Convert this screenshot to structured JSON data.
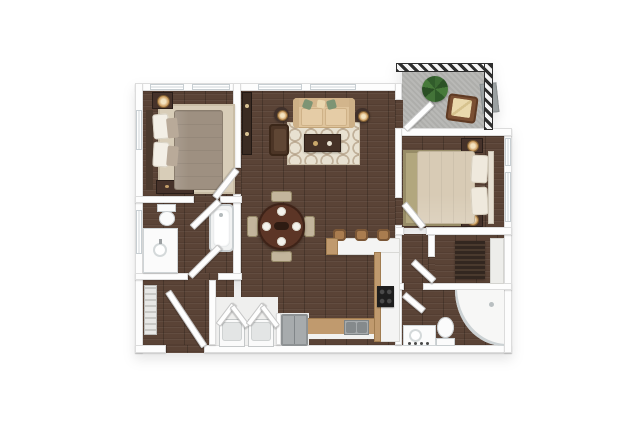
{
  "meta": {
    "image_type": "3d-floor-plan-rendering",
    "view": "top-down",
    "unit_type": "apartment",
    "bedroom_count": 2,
    "bathroom_count": 2,
    "visible_text": ""
  },
  "colors": {
    "bg": "#ffffff",
    "wood": "#5a4336",
    "wall": "#fdfdfd",
    "wall_edge": "#dcdcdc",
    "concrete": "#b5b5b2",
    "rug_beige": "#d8cdb8",
    "rug_cream": "#e8e1d1",
    "rug_olive": "#b2a77e",
    "sofa": "#dfc49c",
    "pillow_green": "#7d9474",
    "dark_wood": "#46322a",
    "bed1": "#9e9081",
    "bed2": "#d8cbb5",
    "lamp": "#c9995c",
    "lamp_glow": "#f3e3c0",
    "fixture": "#fbfbfb",
    "fixture_edge": "#c9ced0",
    "counter": "#f4f4f3",
    "counter_wood": "#c09a6e",
    "steel": "#a7abad",
    "steel_dark": "#8e9294",
    "cooktop": "#1e1e1e",
    "table_wood": "#5c3526",
    "chair": "#c3b59c",
    "stool": "#a97c4f",
    "clothes": "#332720",
    "plant": "#3c6b33",
    "pot": "#8f8f8d",
    "screen_gray": "#9aa0a1",
    "railing": "#2e2e2e"
  },
  "rooms": [
    {
      "id": "bedroom-1",
      "furniture": [
        "bed",
        "nightstand-with-lamp",
        "dresser",
        "area-rug"
      ]
    },
    {
      "id": "living-room",
      "furniture": [
        "sofa",
        "green-accent-pillows",
        "end-table-lamp-left",
        "end-table-lamp-right",
        "armchair",
        "coffee-table",
        "patterned-area-rug",
        "media-console"
      ]
    },
    {
      "id": "dining-area",
      "furniture": [
        "round-dining-table",
        "four-place-settings",
        "four-dining-chairs"
      ]
    },
    {
      "id": "kitchen",
      "furniture": [
        "breakfast-bar",
        "three-bar-stools",
        "cooktop",
        "double-basin-sink",
        "base-cabinets",
        "refrigerator"
      ]
    },
    {
      "id": "bathroom-1",
      "furniture": [
        "toilet",
        "vanity-with-sink",
        "bathtub"
      ]
    },
    {
      "id": "entry-hall",
      "furniture": [
        "entry-door",
        "linen-shelves"
      ]
    },
    {
      "id": "laundry-closet",
      "furniture": [
        "washer",
        "dryer",
        "bifold-doors"
      ]
    },
    {
      "id": "bedroom-2",
      "furniture": [
        "bed",
        "nightstand-with-lamp-upper",
        "nightstand-with-lamp-lower",
        "area-rug"
      ]
    },
    {
      "id": "walk-in-closet",
      "furniture": [
        "hanging-clothes",
        "shelf"
      ]
    },
    {
      "id": "bathroom-2",
      "furniture": [
        "vanity-with-sink",
        "toilet",
        "curved-shower"
      ]
    },
    {
      "id": "balcony",
      "furniture": [
        "potted-plant",
        "patio-chair",
        "privacy-screen",
        "railing"
      ]
    }
  ]
}
